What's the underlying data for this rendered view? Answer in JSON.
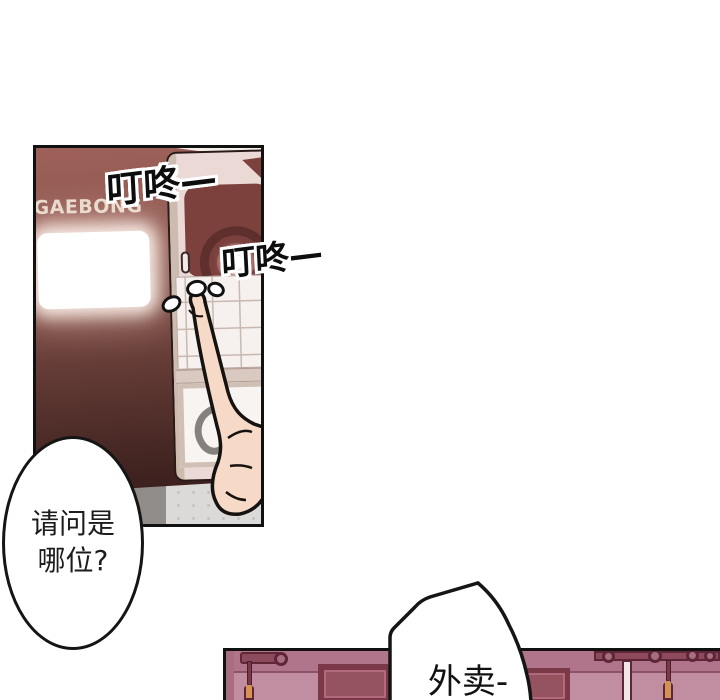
{
  "comic": {
    "sfx_dingdong_1": "叮咚—",
    "sfx_dingdong_2": "叮咚—",
    "door_sign": "GAEBONG",
    "bubble_whois_line1": "请问是",
    "bubble_whois_line2": "哪位?",
    "bubble_delivery": "外卖-"
  },
  "palette": {
    "door_top": "#9e6159",
    "door_bottom": "#3a1f1d",
    "intercom_body": "#ead9d4",
    "camera_block": "#7c403d",
    "skin": "#f7d9c7",
    "floor_grey": "#dcdad8",
    "wall_pink": "#c18da0",
    "wall_band": "#b0758a",
    "frame_maroon": "#7b3948",
    "handle_orange": "#d29355",
    "outline_black": "#111111",
    "sign_text": "#e7dbcd"
  }
}
